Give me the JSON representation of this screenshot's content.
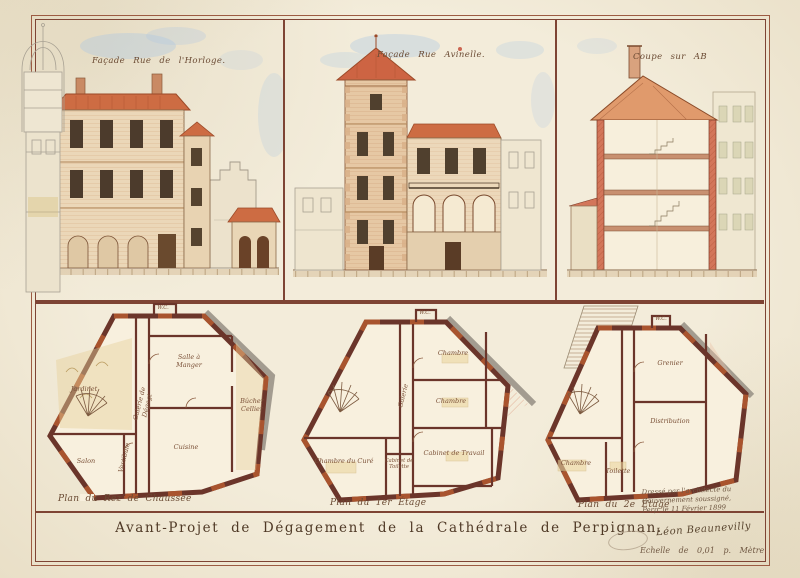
{
  "sheet": {
    "title": "Avant-Projet de Dégagement de la Cathédrale de Perpignan.",
    "scale": "Echelle de 0,01 p. Mètre",
    "signature": "Léon Beaunevilly",
    "inscription_line1": "Dressé par l'architecte du",
    "inscription_line2": "Gouvernement soussigné,",
    "inscription_line3": "Perp. le 11 Février 1899"
  },
  "elevations": [
    {
      "label": "Façade Rue de l'Horloge."
    },
    {
      "label": "Façade Rue Avinelle."
    },
    {
      "label": "Coupe sur AB"
    }
  ],
  "plans": [
    {
      "label": "Plan du Rez de Chaussée",
      "rooms": {
        "wc": "W.C.",
        "jardinet": "Jardinet",
        "salle": "Salle à Manger",
        "bucher": "Bûcher Cellier",
        "salon": "Salon",
        "cuisine": "Cuisine",
        "galerie": "Galerie de Dégagt",
        "vestibule": "Vestibule"
      }
    },
    {
      "label": "Plan du 1er Étage",
      "rooms": {
        "wc": "W.C.",
        "chambre1": "Chambre",
        "chambre2": "Chambre",
        "cabinet_travail": "Cabinet de Travail",
        "chambre_cure": "Chambre du Curé",
        "cabinet_toilette": "Cabinet de Toilette",
        "galerie": "Galerie"
      }
    },
    {
      "label": "Plan du 2e Étage",
      "rooms": {
        "wc": "W.C.",
        "grenier": "Grenier",
        "distribution": "Distribution",
        "chambre": "Chambre",
        "toilette": "Toilette"
      }
    }
  ],
  "colors": {
    "paper": "#f1e9d6",
    "frame": "#7e4434",
    "roof": "#cd6c43",
    "plan_wall": "#6b352a",
    "plan_wall_accent": "#b4592f",
    "ink": "#4f3926",
    "sky": "#aec8e2"
  }
}
